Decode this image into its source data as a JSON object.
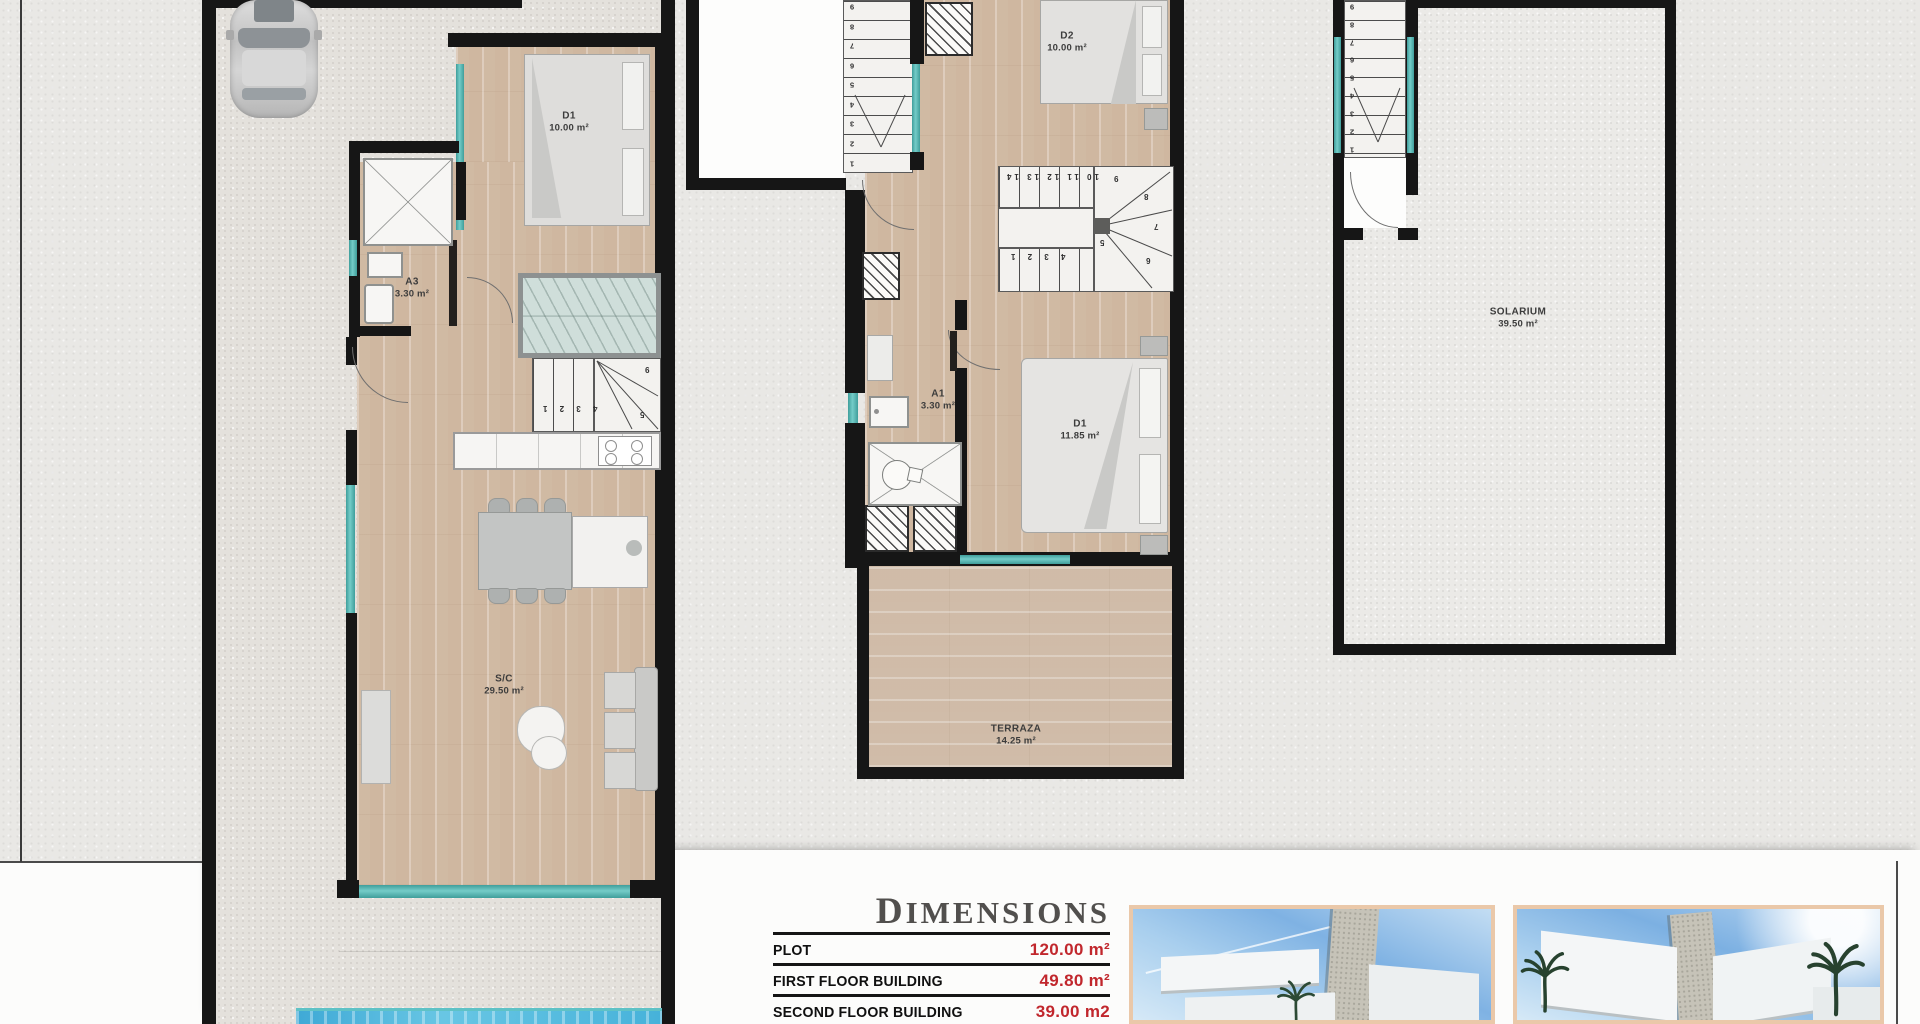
{
  "plans": {
    "ground": {
      "rooms": {
        "d1": {
          "label": "D1",
          "area": "10.00 m²"
        },
        "a3": {
          "label": "A3",
          "area": "3.30 m²"
        },
        "sc": {
          "label": "S/C",
          "area": "29.50 m²"
        }
      },
      "stair_numbers": {
        "run": "4 3 2 1",
        "n5": "5",
        "n9": "9"
      }
    },
    "first": {
      "rooms": {
        "d2": {
          "label": "D2",
          "area": "10.00 m²"
        },
        "a1": {
          "label": "A1",
          "area": "3.30 m²"
        },
        "d1": {
          "label": "D1",
          "area": "11.85 m²"
        },
        "terraza": {
          "label": "TERRAZA",
          "area": "14.25 m²"
        }
      },
      "stair_numbers": {
        "upper_column": [
          "9",
          "8",
          "7",
          "6",
          "5",
          "4",
          "3",
          "2",
          "1"
        ],
        "mid_run": "10 11 12 13 14",
        "low_run": "4 3 2 1",
        "n9": "9",
        "n8": "8",
        "n7": "7",
        "n6": "6",
        "n5": "5"
      }
    },
    "roof": {
      "rooms": {
        "solarium": {
          "label": "SOLARIUM",
          "area": "39.50 m²"
        }
      },
      "stair_numbers": {
        "column": [
          "9",
          "8",
          "7",
          "6",
          "5",
          "4",
          "3",
          "2",
          "1"
        ]
      }
    }
  },
  "dimensions": {
    "title": "DIMENSIONS",
    "rows": [
      {
        "label": "PLOT",
        "value": "120.00 m²"
      },
      {
        "label": "FIRST FLOOR BUILDING",
        "value": "49.80 m²"
      },
      {
        "label": "SECOND FLOOR BUILDING",
        "value": "39.00 m2"
      }
    ]
  },
  "colors": {
    "accent_red": "#c1272d",
    "wall_black": "#161616",
    "window_teal": "#5fbdba",
    "pool_water": "#45b1da",
    "render_frame": "#eac8a9"
  }
}
